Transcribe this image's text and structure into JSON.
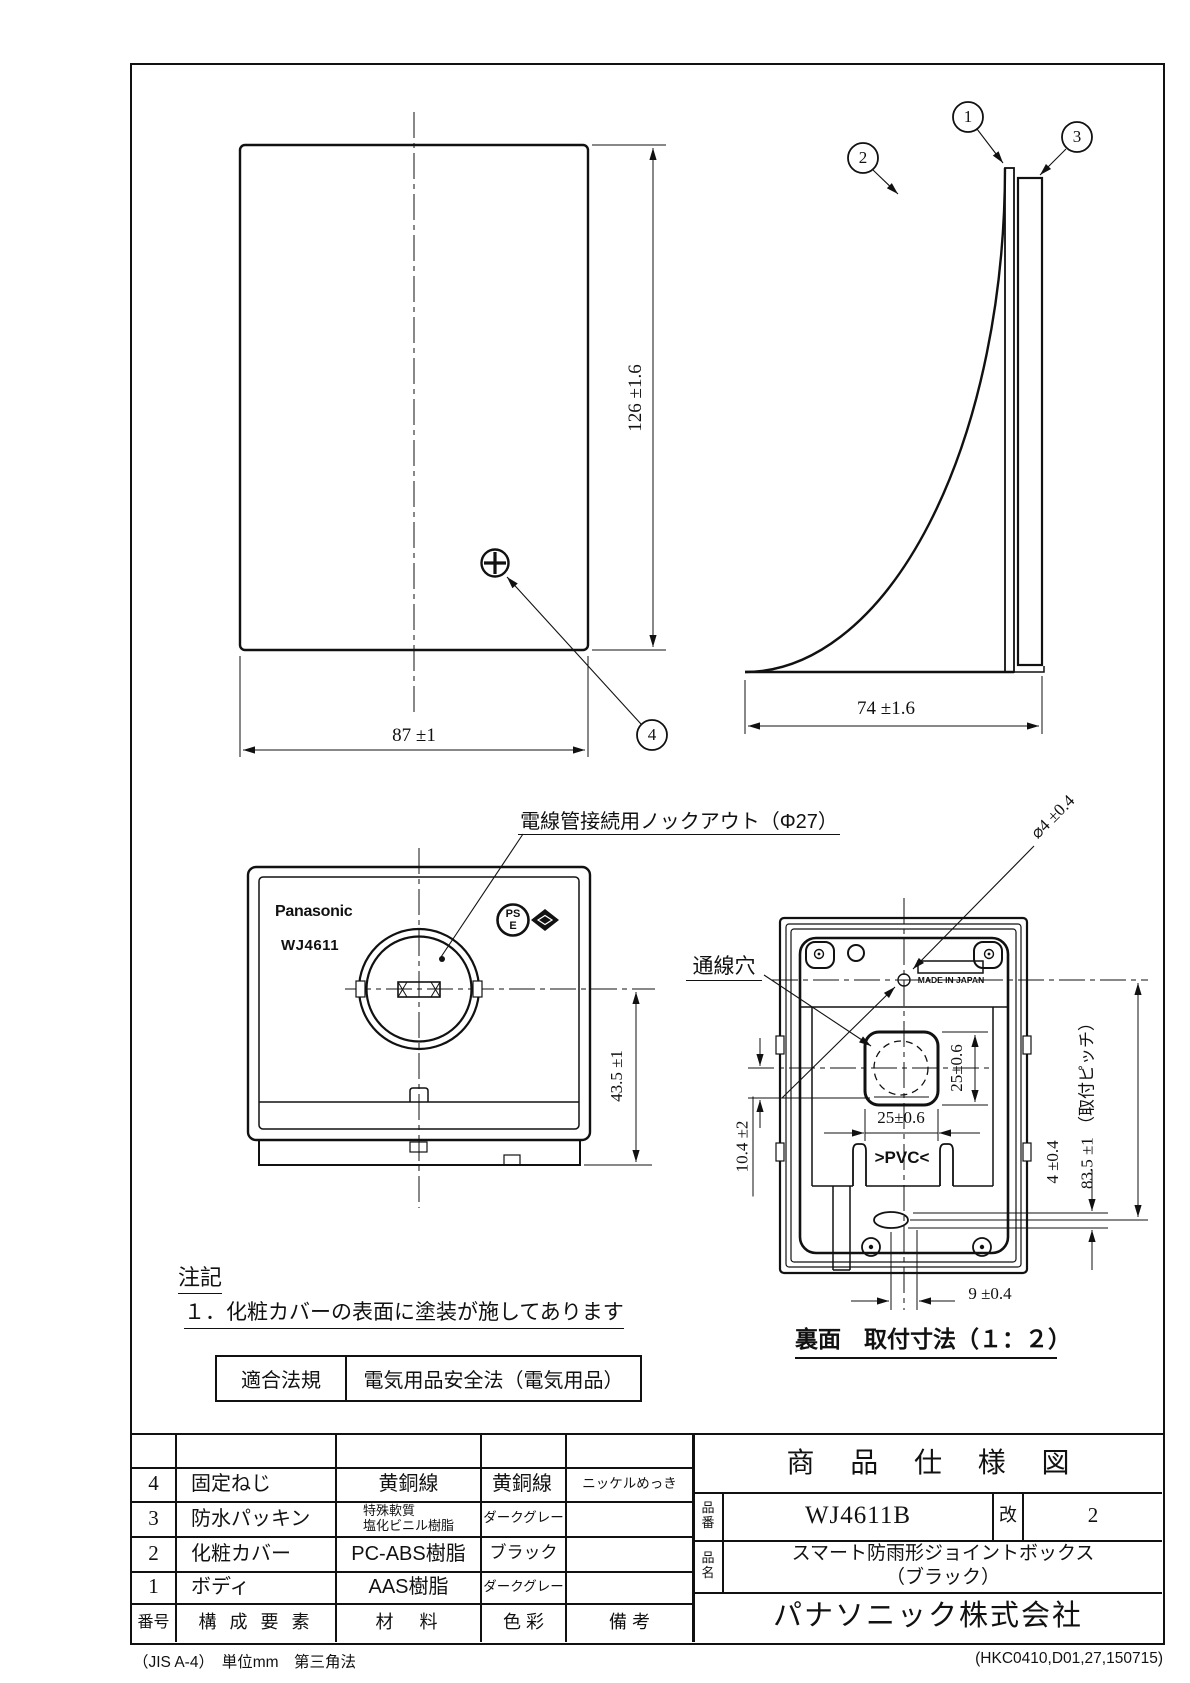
{
  "callouts": [
    "1",
    "2",
    "3",
    "4"
  ],
  "views": {
    "front": {
      "dim_height": "126 ±1.6",
      "dim_width": "87 ±1"
    },
    "side": {
      "dim_depth": "74 ±1.6"
    },
    "bottom": {
      "logo": "Panasonic",
      "model": "WJ4611",
      "pse_top": "PS",
      "pse_bottom": "E",
      "dim_height": "43.5 ±1",
      "knockout_label": "電線管接続用ノックアウト（Φ27）"
    },
    "back": {
      "caption": "裏面　取付寸法（１：２）",
      "wire_hole_label": "通線穴",
      "dim_hole_dia": "⌀4 ±0.4",
      "dim_hole_h": "25±0.6",
      "dim_hole_w": "25±0.6",
      "dim_offset": "10.4 ±2",
      "dim_slot": "4 ±0.4",
      "dim_pitch": "83.5 ±1 （取付ピッチ）",
      "dim_bottom": "9 ±0.4",
      "pvc": ">PVC<",
      "made_in": "MADE IN JAPAN"
    }
  },
  "notes": {
    "title": "注記",
    "line1": "１．化粧カバーの表面に塗装が施してあります"
  },
  "law": {
    "label": "適合法規",
    "value": "電気用品安全法（電気用品）"
  },
  "parts_table": {
    "headers": {
      "no": "番号",
      "component": "構 成 要 素",
      "material": "材　料",
      "color": "色 彩",
      "remarks": "備 考"
    },
    "rows": [
      {
        "no": "4",
        "component": "固定ねじ",
        "material": "黄銅線",
        "material2": "",
        "color": "",
        "remarks": "ニッケルめっき"
      },
      {
        "no": "3",
        "component": "防水パッキン",
        "material": "特殊軟質",
        "material2": "塩化ビニル樹脂",
        "color": "ダークグレー",
        "remarks": ""
      },
      {
        "no": "2",
        "component": "化粧カバー",
        "material": "PC-ABS樹脂",
        "material2": "",
        "color": "ブラック",
        "remarks": ""
      },
      {
        "no": "1",
        "component": "ボディ",
        "material": "AAS樹脂",
        "material2": "",
        "color": "ダークグレー",
        "remarks": ""
      }
    ]
  },
  "title_block": {
    "title": "商 品 仕 様 図",
    "part_no_label": "品番",
    "part_no": "WJ4611B",
    "rev_label": "改",
    "rev": "2",
    "name_label": "品名",
    "name_line1": "スマート防雨形ジョイントボックス",
    "name_line2": "（ブラック）",
    "company": "パナソニック株式会社"
  },
  "footer": {
    "left": "（JIS A-4）　単位mm　第三角法",
    "right": "(HKC0410,D01,27,150715)"
  }
}
